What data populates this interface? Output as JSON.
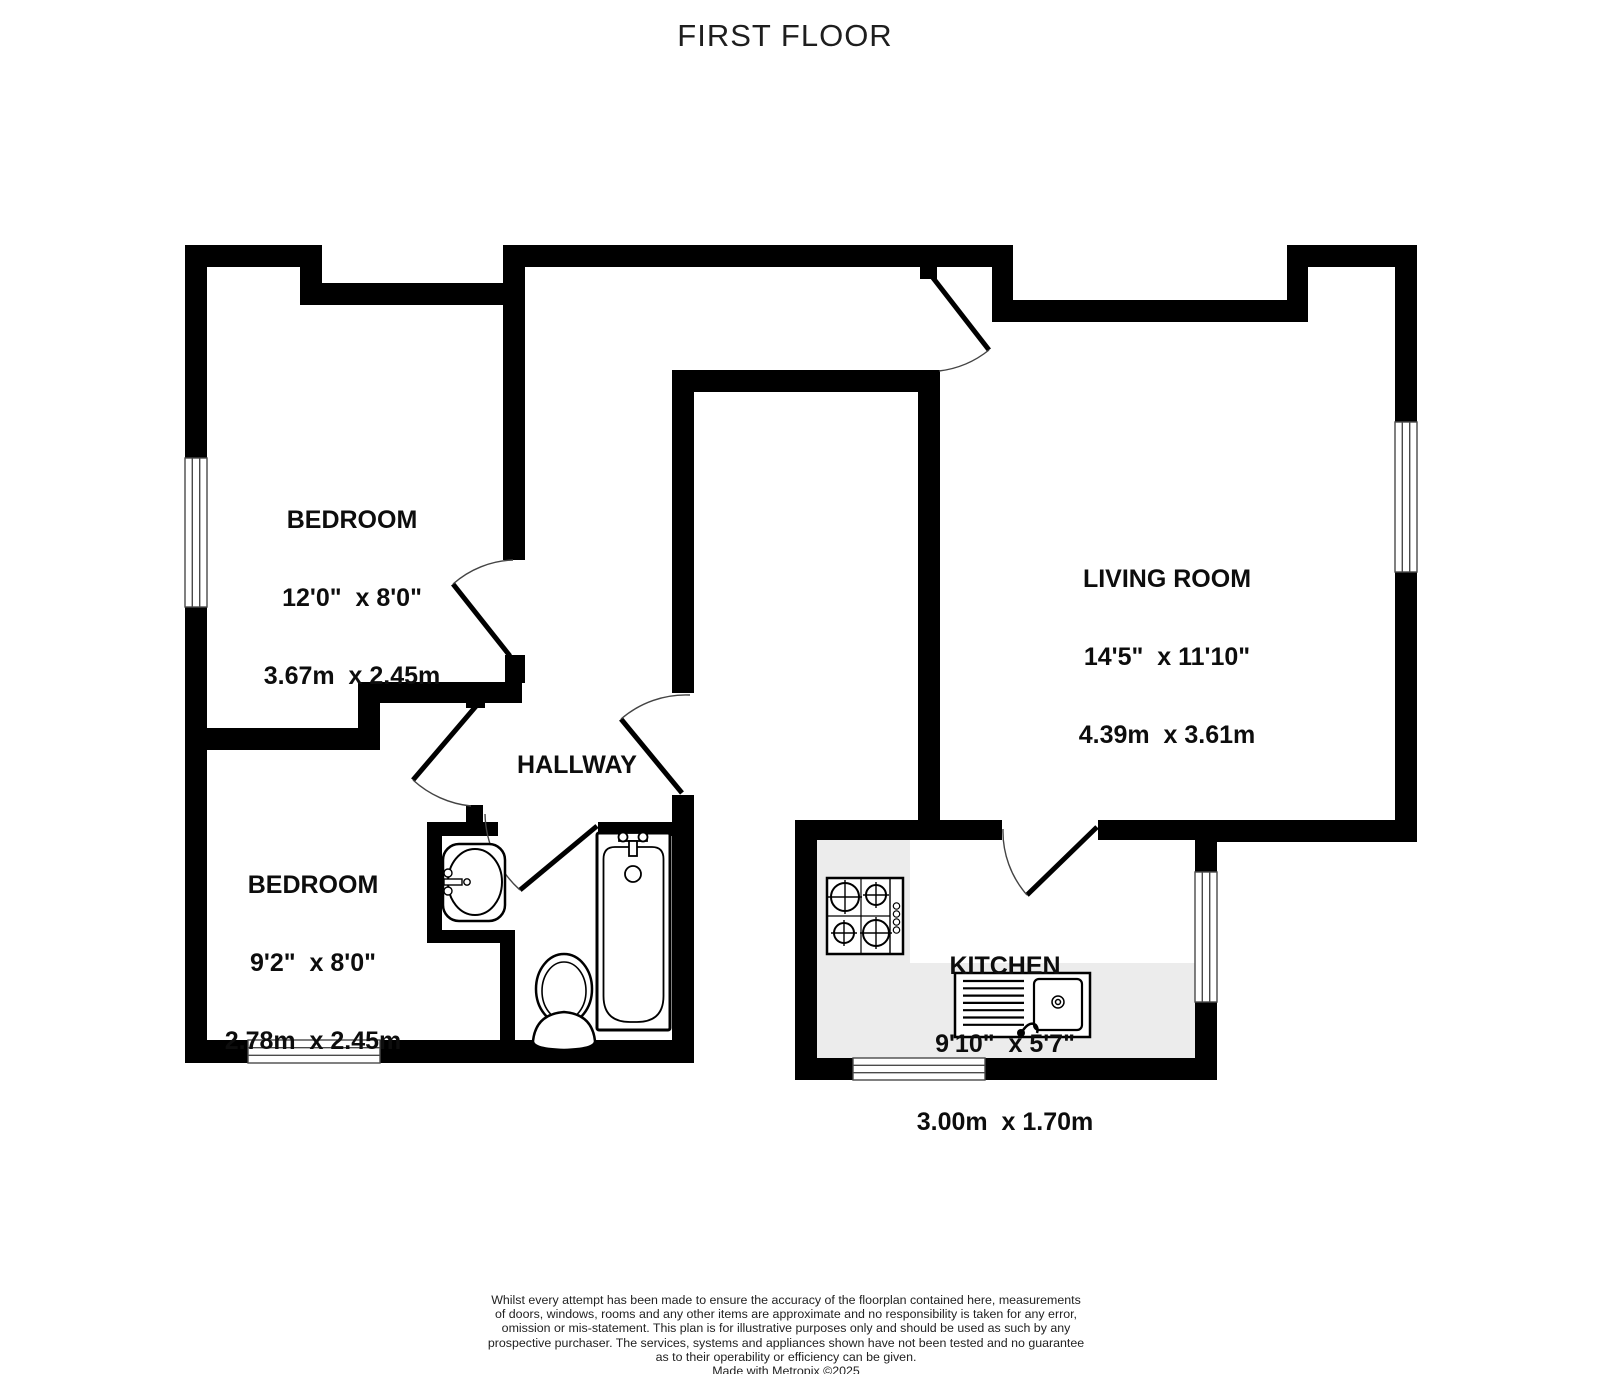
{
  "title": "FIRST FLOOR",
  "rooms": [
    {
      "name": "BEDROOM",
      "imperial": "12'0\"  x 8'0\"",
      "metric": "3.67m  x 2.45m"
    },
    {
      "name": "LIVING ROOM",
      "imperial": "14'5\"  x 11'10\"",
      "metric": "4.39m  x 3.61m"
    },
    {
      "name": "BEDROOM",
      "imperial": "9'2\"  x 8'0\"",
      "metric": "2.78m  x 2.45m"
    },
    {
      "name": "HALLWAY"
    },
    {
      "name": "KITCHEN",
      "imperial": "9'10\"  x 5'7\"",
      "metric": "3.00m  x 1.70m"
    }
  ],
  "fixtures": [
    "bathtub",
    "toilet",
    "hand-basin",
    "hob",
    "kitchen-sink-drainer",
    "kitchen-counter"
  ],
  "disclaimer": {
    "lines": [
      "Whilst every attempt has been made to ensure the accuracy of the floorplan contained here, measurements",
      "of doors, windows, rooms and any other items are approximate and no responsibility is taken for any error,",
      "omission or mis-statement. This plan is for illustrative purposes only and should be used as such by any",
      "prospective purchaser. The services, systems and appliances shown have not been tested and no guarantee",
      "as to their operability or efficiency can be given.",
      "Made with Metropix ©2025"
    ]
  },
  "colors": {
    "wall": "#000000",
    "counter": "#ececec",
    "text": "#0d0d0d"
  }
}
